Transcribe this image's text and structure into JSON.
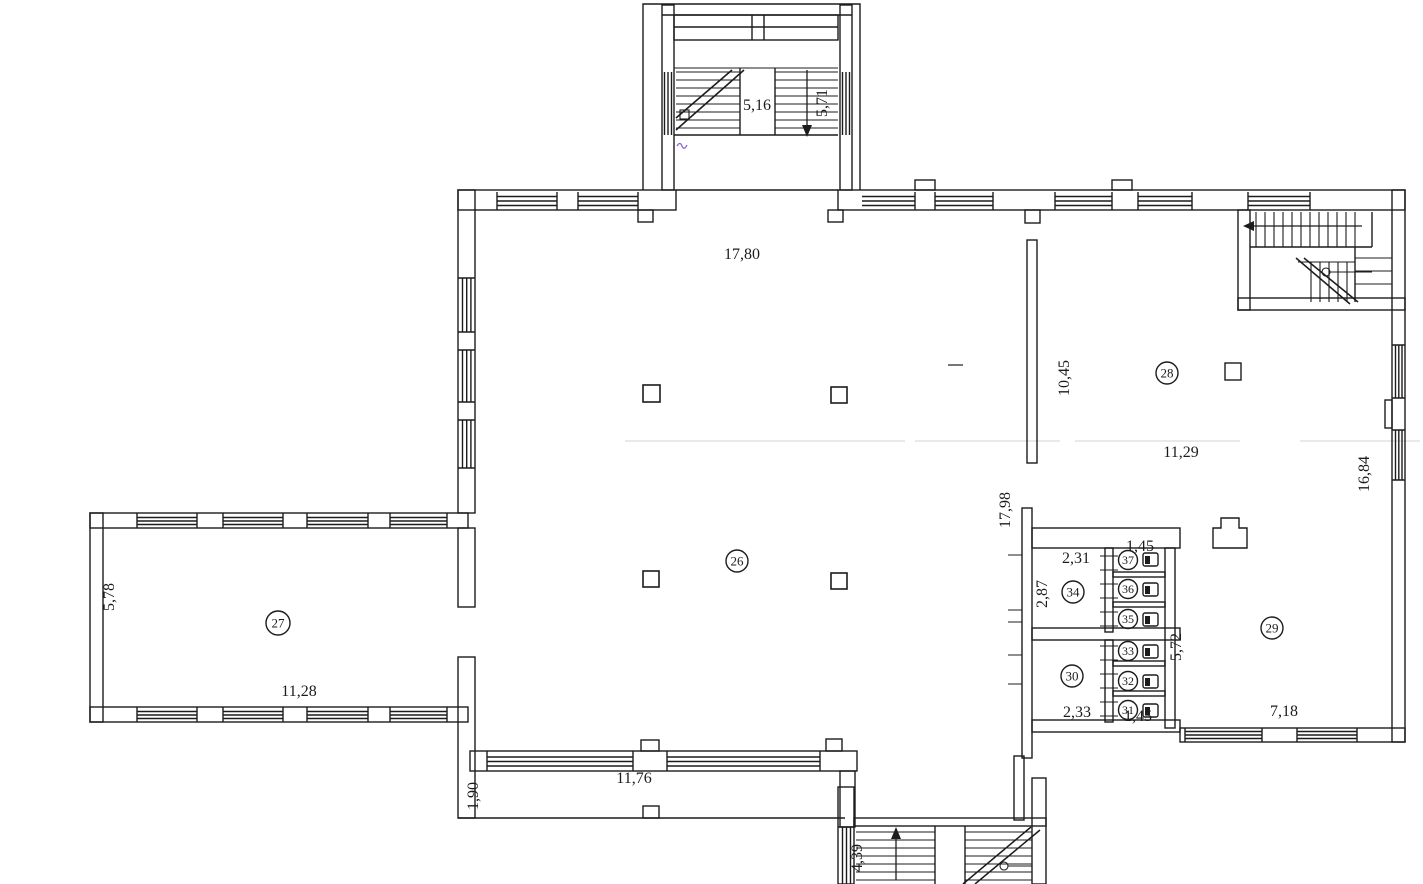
{
  "drawing": {
    "kind": "scanned architectural floor plan",
    "line_color": "#1c1c1c",
    "pen_mark_color": "#8a5fd6"
  },
  "labels": {
    "room_26": "26",
    "room_27": "27",
    "room_28": "28",
    "room_29": "29",
    "room_30": "30",
    "room_31": "31",
    "room_32": "32",
    "room_33": "33",
    "room_34": "34",
    "room_35": "35",
    "room_36": "36",
    "room_37": "37"
  },
  "dims": {
    "stair_top_width": "5,16",
    "stair_top_height": "5,71",
    "hall_top_width": "17,80",
    "partition_length": "10,45",
    "room28_width": "11,29",
    "right_wall_length": "16,84",
    "hall_right_wall": "17,98",
    "wc_top_width": "2,31",
    "wc_stall_depth_top": "1,45",
    "wc_top_height": "2,87",
    "wc_block_length": "5,72",
    "wc_bottom_width": "2,33",
    "wc_stall_depth_bottom": "1,45",
    "room29_width": "7,18",
    "wing_width": "11,28",
    "wing_height": "5,78",
    "terrace_width": "11,76",
    "terrace_depth": "1,90",
    "stair_bottom_height": "4,39"
  }
}
